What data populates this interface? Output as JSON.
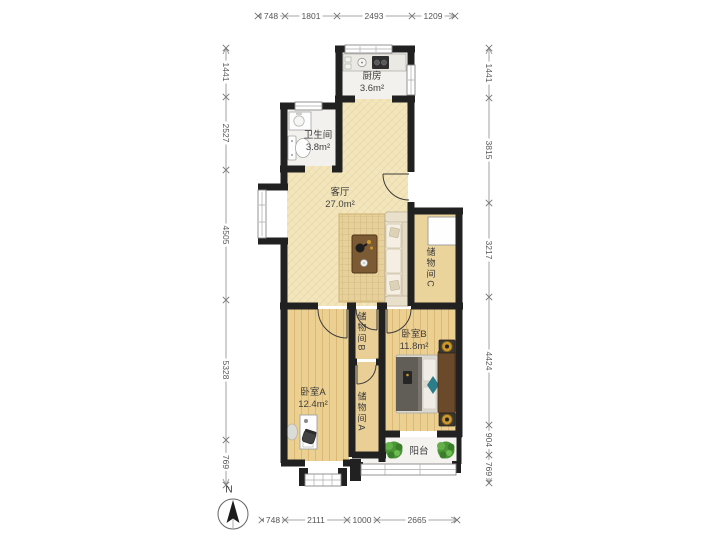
{
  "rooms": {
    "kitchen": {
      "name": "厨房",
      "area": "3.6m²"
    },
    "bathroom": {
      "name": "卫生间",
      "area": "3.8m²"
    },
    "living_room": {
      "name": "客厅",
      "area": "27.0m²"
    },
    "storage_c": {
      "name": "储物间C"
    },
    "storage_b": {
      "name": "储物间B"
    },
    "storage_a": {
      "name": "储物间A"
    },
    "bedroom_b": {
      "name": "卧室B",
      "area": "11.8m²"
    },
    "bedroom_a": {
      "name": "卧室A",
      "area": "12.4m²"
    },
    "balcony": {
      "name": "阳台"
    }
  },
  "dimensions_mm": {
    "top": [
      "748",
      "1801",
      "2493",
      "1209"
    ],
    "bottom": [
      "748",
      "2111",
      "1000",
      "2665"
    ],
    "left": [
      "1441",
      "2527",
      "4505",
      "5328",
      "769"
    ],
    "right": [
      "1441",
      "3815",
      "3217",
      "4424",
      "904",
      "769"
    ]
  },
  "compass": {
    "label": "N"
  },
  "colors": {
    "wall": "#212121",
    "wood_floor": "#ecd092",
    "living_floor": "#f3e6bd",
    "tile_floor": "#f2f1ed",
    "rug": "#e6d19c",
    "plant": "#57a33f",
    "lamp_gold": "#c9982f",
    "accent_teal": "#2c7d8a",
    "dim_text": "#555555"
  }
}
